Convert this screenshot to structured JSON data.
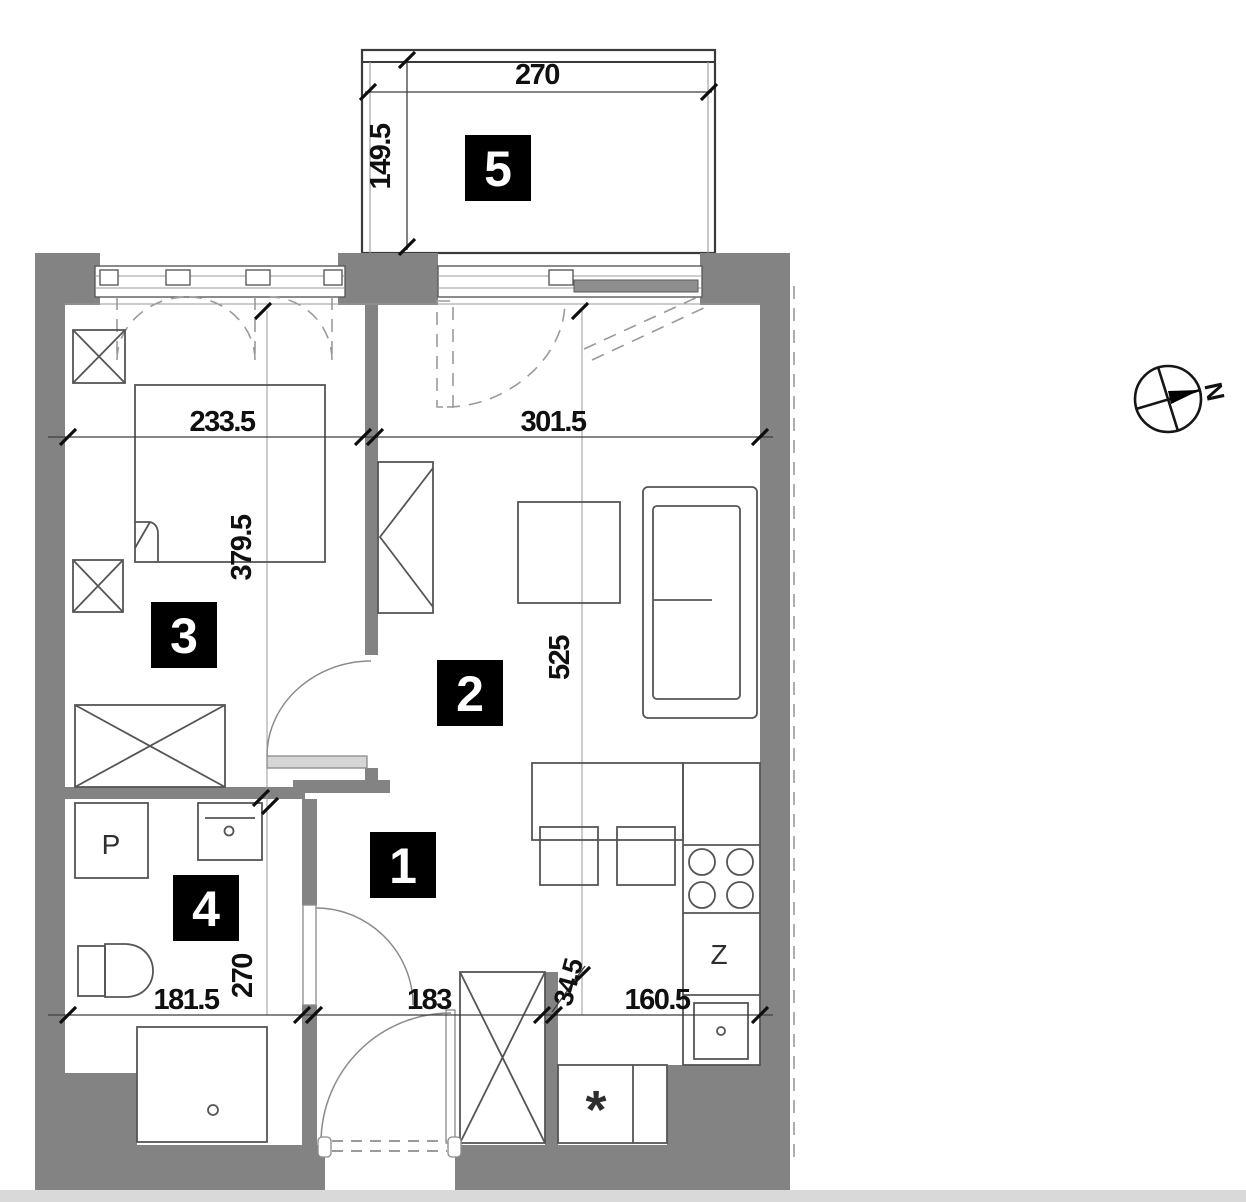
{
  "plan": {
    "type": "apartment-floor-plan",
    "rooms": [
      {
        "number": "1"
      },
      {
        "number": "2"
      },
      {
        "number": "3"
      },
      {
        "number": "4"
      },
      {
        "number": "5"
      }
    ],
    "dims": {
      "balcony_width": "270",
      "balcony_depth": "149.5",
      "bedroom_width": "233.5",
      "bedroom_depth": "379.5",
      "living_width": "301.5",
      "living_depth": "525",
      "bath_width": "181.5",
      "bath_depth": "270",
      "hall_width": "183",
      "recess_width": "34.5",
      "kitchen_width": "160.5"
    },
    "fixtures": {
      "washing_machine": "P",
      "kitchen_cabinet": "Z",
      "fridge": "*"
    },
    "compass": {
      "north": "N"
    },
    "colors": {
      "wall": "#838383",
      "label_bg": "#000000",
      "label_fg": "#ffffff",
      "line": "#4d4d4d",
      "background": "#ffffff"
    }
  }
}
